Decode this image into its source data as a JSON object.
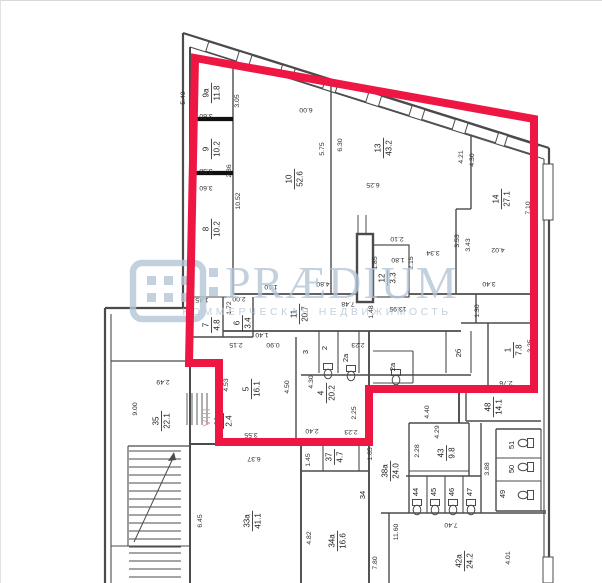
{
  "watermark": {
    "brand": "PRÆDIUM",
    "subtitle": "КОММЕРЧЕСКАЯ НЕДВИЖИМОСТЬ",
    "color": "#b5c5d7"
  },
  "highlight": {
    "label": "VIII",
    "color": "#ee1744",
    "label_color": "#e294a2",
    "points": "194,57 533,118 533,388 368,388 368,441 218,441 218,362 188,362"
  },
  "plan": {
    "line_color": "#4b4b4b",
    "thick_color": "#101010",
    "text_color": "#1c1c1c",
    "rooms": [
      {
        "num": "9а",
        "area": "11.8",
        "x": 210,
        "y": 92
      },
      {
        "num": "9",
        "area": "10.2",
        "x": 210,
        "y": 148
      },
      {
        "num": "8",
        "area": "10.2",
        "x": 210,
        "y": 228
      },
      {
        "num": "10",
        "area": "52.6",
        "x": 293,
        "y": 178
      },
      {
        "num": "13",
        "area": "43.2",
        "x": 382,
        "y": 147
      },
      {
        "num": "14",
        "area": "27.1",
        "x": 500,
        "y": 198
      },
      {
        "num": "12",
        "area": "3.3",
        "x": 386,
        "y": 277
      },
      {
        "num": "11",
        "area": "20.7",
        "x": 298,
        "y": 313
      },
      {
        "num": "6",
        "area": "3.4",
        "x": 241,
        "y": 322
      },
      {
        "num": "7",
        "area": "4.8",
        "x": 210,
        "y": 324
      },
      {
        "num": "5",
        "area": "16.1",
        "x": 250,
        "y": 388
      },
      {
        "num": "4",
        "area": "20.2",
        "x": 325,
        "y": 392
      },
      {
        "num": "1",
        "area": "7.8",
        "x": 512,
        "y": 349
      },
      {
        "num": "48",
        "area": "14.1",
        "x": 492,
        "y": 406
      },
      {
        "num": "30",
        "area": "2.4",
        "x": 222,
        "y": 420
      },
      {
        "num": "35",
        "area": "22.1",
        "x": 160,
        "y": 420
      },
      {
        "num": "33а",
        "area": "41.1",
        "x": 251,
        "y": 520
      },
      {
        "num": "34а",
        "area": "16.6",
        "x": 336,
        "y": 540
      },
      {
        "num": "37",
        "area": "4.7",
        "x": 333,
        "y": 456
      },
      {
        "num": "38а",
        "area": "24.0",
        "x": 389,
        "y": 470
      },
      {
        "num": "43",
        "area": "9.8",
        "x": 445,
        "y": 452
      },
      {
        "num": "42а",
        "area": "24.2",
        "x": 463,
        "y": 560
      }
    ],
    "stalls": [
      {
        "t": "3",
        "x": 307,
        "y": 351
      },
      {
        "t": "2",
        "x": 326,
        "y": 347
      },
      {
        "t": "2а",
        "x": 347,
        "y": 357
      },
      {
        "t": "2а",
        "x": 394,
        "y": 366
      },
      {
        "t": "2б",
        "x": 460,
        "y": 352
      },
      {
        "t": "34",
        "x": 364,
        "y": 494
      },
      {
        "t": "44",
        "x": 417,
        "y": 491
      },
      {
        "t": "45",
        "x": 435,
        "y": 491
      },
      {
        "t": "46",
        "x": 453,
        "y": 491
      },
      {
        "t": "47",
        "x": 471,
        "y": 491
      },
      {
        "t": "49",
        "x": 504,
        "y": 493
      },
      {
        "t": "50",
        "x": 513,
        "y": 468
      },
      {
        "t": "51",
        "x": 513,
        "y": 444
      }
    ],
    "dims": [
      {
        "t": "5.49",
        "x": 184,
        "y": 97,
        "rot": -90
      },
      {
        "t": "3.05",
        "x": 238,
        "y": 100,
        "rot": -90
      },
      {
        "t": "3.60",
        "x": 205,
        "y": 113,
        "rot": 180
      },
      {
        "t": "3.58",
        "x": 205,
        "y": 168,
        "rot": 180
      },
      {
        "t": "3.60",
        "x": 205,
        "y": 185,
        "rot": 180
      },
      {
        "t": "2.86",
        "x": 230,
        "y": 170,
        "rot": -90
      },
      {
        "t": "10.52",
        "x": 239,
        "y": 200,
        "rot": -90
      },
      {
        "t": "2.82",
        "x": 192,
        "y": 248,
        "rot": -90
      },
      {
        "t": "6.00",
        "x": 305,
        "y": 107,
        "rot": 180
      },
      {
        "t": "5.75",
        "x": 323,
        "y": 148,
        "rot": -90
      },
      {
        "t": "6.30",
        "x": 341,
        "y": 144,
        "rot": -90
      },
      {
        "t": "6.25",
        "x": 372,
        "y": 182,
        "rot": 180
      },
      {
        "t": "4.21",
        "x": 462,
        "y": 156,
        "rot": -90
      },
      {
        "t": "4.30",
        "x": 473,
        "y": 159,
        "rot": -90
      },
      {
        "t": "7.10",
        "x": 529,
        "y": 207,
        "rot": -90
      },
      {
        "t": "4.02",
        "x": 497,
        "y": 247,
        "rot": 180
      },
      {
        "t": "3.40",
        "x": 488,
        "y": 281,
        "rot": 180
      },
      {
        "t": "3.53",
        "x": 458,
        "y": 240,
        "rot": -90
      },
      {
        "t": "3.43",
        "x": 469,
        "y": 244,
        "rot": -90
      },
      {
        "t": "3.34",
        "x": 432,
        "y": 250,
        "rot": 180
      },
      {
        "t": "2.15",
        "x": 412,
        "y": 262,
        "rot": -90
      },
      {
        "t": "2.10",
        "x": 396,
        "y": 236,
        "rot": 180
      },
      {
        "t": "1.80",
        "x": 397,
        "y": 257,
        "rot": 180
      },
      {
        "t": "1.85",
        "x": 376,
        "y": 262,
        "rot": -90
      },
      {
        "t": "1.30",
        "x": 478,
        "y": 310,
        "rot": -90
      },
      {
        "t": "13.95",
        "x": 397,
        "y": 306,
        "rot": 180
      },
      {
        "t": "1.48",
        "x": 372,
        "y": 311,
        "rot": -90
      },
      {
        "t": "7.48",
        "x": 347,
        "y": 301,
        "rot": 180
      },
      {
        "t": "4.80",
        "x": 322,
        "y": 281,
        "rot": 180
      },
      {
        "t": "1.10",
        "x": 270,
        "y": 284,
        "rot": 180
      },
      {
        "t": "1.45",
        "x": 201,
        "y": 297,
        "rot": 180
      },
      {
        "t": "2.00",
        "x": 238,
        "y": 296,
        "rot": 180
      },
      {
        "t": "1.72",
        "x": 230,
        "y": 307,
        "rot": -90
      },
      {
        "t": "2.15",
        "x": 235,
        "y": 342,
        "rot": 180
      },
      {
        "t": "1.40",
        "x": 261,
        "y": 332,
        "rot": 180
      },
      {
        "t": "0.90",
        "x": 272,
        "y": 342,
        "rot": 180
      },
      {
        "t": "2.23",
        "x": 357,
        "y": 342,
        "rot": 180
      },
      {
        "t": "4.53",
        "x": 227,
        "y": 384,
        "rot": -90
      },
      {
        "t": "4.50",
        "x": 288,
        "y": 386,
        "rot": -90
      },
      {
        "t": "4.30",
        "x": 312,
        "y": 381,
        "rot": -90
      },
      {
        "t": "3.55",
        "x": 250,
        "y": 432,
        "rot": 180
      },
      {
        "t": "2.40",
        "x": 311,
        "y": 428,
        "rot": 180
      },
      {
        "t": "2.23",
        "x": 350,
        "y": 429,
        "rot": 180
      },
      {
        "t": "2.25",
        "x": 355,
        "y": 412,
        "rot": -90
      },
      {
        "t": "1.65",
        "x": 371,
        "y": 453,
        "rot": -90
      },
      {
        "t": "2.49",
        "x": 162,
        "y": 379,
        "rot": 180
      },
      {
        "t": "9.00",
        "x": 136,
        "y": 408,
        "rot": -90
      },
      {
        "t": "6.45",
        "x": 201,
        "y": 520,
        "rot": -90
      },
      {
        "t": "6.37",
        "x": 253,
        "y": 456,
        "rot": 180
      },
      {
        "t": "1.45",
        "x": 309,
        "y": 459,
        "rot": -90
      },
      {
        "t": "4.82",
        "x": 310,
        "y": 537,
        "rot": -90
      },
      {
        "t": "7.80",
        "x": 376,
        "y": 562,
        "rot": -90
      },
      {
        "t": "11.60",
        "x": 397,
        "y": 531,
        "rot": -90
      },
      {
        "t": "7.40",
        "x": 450,
        "y": 522,
        "rot": 180
      },
      {
        "t": "2.28",
        "x": 418,
        "y": 450,
        "rot": -90
      },
      {
        "t": "4.29",
        "x": 438,
        "y": 431,
        "rot": -90
      },
      {
        "t": "4.40",
        "x": 428,
        "y": 411,
        "rot": -90
      },
      {
        "t": "3.88",
        "x": 488,
        "y": 468,
        "rot": -90
      },
      {
        "t": "3.25",
        "x": 531,
        "y": 345,
        "rot": -90
      },
      {
        "t": "2.76",
        "x": 505,
        "y": 380,
        "rot": 180
      },
      {
        "t": "4.01",
        "x": 509,
        "y": 557,
        "rot": -90
      }
    ]
  },
  "geometry": {
    "walls": [
      [
        182,
        32,
        548,
        147,
        2.2
      ],
      [
        189,
        46,
        543,
        158,
        1.1
      ],
      [
        182,
        32,
        182,
        307,
        2.2
      ],
      [
        548,
        147,
        548,
        583,
        2.2
      ],
      [
        543,
        158,
        543,
        583,
        1.1
      ],
      [
        104,
        307,
        189,
        307,
        2.2
      ],
      [
        104,
        307,
        104,
        583,
        2.2
      ],
      [
        110,
        313,
        110,
        583,
        1.1
      ],
      [
        189,
        46,
        189,
        583,
        2.0
      ],
      [
        110,
        360,
        189,
        360,
        1.3
      ],
      [
        127,
        445,
        189,
        445,
        1.3
      ],
      [
        127,
        445,
        127,
        545,
        1.1
      ],
      [
        110,
        545,
        189,
        545,
        1.1
      ],
      [
        232,
        48,
        232,
        293,
        1.4
      ],
      [
        189,
        118,
        232,
        118,
        4.2
      ],
      [
        189,
        172,
        232,
        172,
        4.2
      ],
      [
        330,
        79,
        330,
        293,
        1.4
      ],
      [
        470,
        122,
        470,
        208,
        1.4
      ],
      [
        455,
        208,
        470,
        208,
        1.4
      ],
      [
        455,
        208,
        455,
        293,
        1.4
      ],
      [
        232,
        293,
        535,
        293,
        1.8
      ],
      [
        189,
        296,
        232,
        296,
        1.1
      ],
      [
        222,
        296,
        222,
        336,
        1.4
      ],
      [
        252,
        296,
        252,
        336,
        1.4
      ],
      [
        189,
        336,
        252,
        336,
        1.4
      ],
      [
        222,
        330,
        460,
        330,
        1.8
      ],
      [
        475,
        293,
        475,
        322,
        1.4
      ],
      [
        460,
        322,
        535,
        322,
        1.4
      ],
      [
        487,
        322,
        487,
        390,
        1.4
      ],
      [
        295,
        336,
        295,
        443,
        1.4
      ],
      [
        368,
        330,
        368,
        583,
        1.9
      ],
      [
        189,
        443,
        368,
        443,
        1.9
      ],
      [
        300,
        443,
        300,
        583,
        1.9
      ],
      [
        318,
        330,
        318,
        372,
        1.1
      ],
      [
        337,
        330,
        337,
        372,
        1.1
      ],
      [
        358,
        330,
        358,
        372,
        1.1
      ],
      [
        445,
        330,
        445,
        372,
        1.1
      ],
      [
        470,
        330,
        470,
        372,
        1.1
      ],
      [
        300,
        374,
        470,
        374,
        1.4
      ],
      [
        372,
        350,
        412,
        350,
        1.1
      ],
      [
        412,
        350,
        412,
        382,
        1.1
      ],
      [
        372,
        382,
        412,
        382,
        1.1
      ],
      [
        357,
        214,
        357,
        233,
        1.0
      ],
      [
        365,
        214,
        365,
        233,
        1.0
      ],
      [
        458,
        390,
        458,
        422,
        1.9
      ],
      [
        408,
        422,
        468,
        422,
        1.4
      ],
      [
        408,
        422,
        408,
        512,
        1.4
      ],
      [
        468,
        422,
        468,
        475,
        1.4
      ],
      [
        405,
        475,
        480,
        475,
        1.4
      ],
      [
        426,
        475,
        426,
        512,
        1.1
      ],
      [
        444,
        475,
        444,
        512,
        1.1
      ],
      [
        462,
        475,
        462,
        512,
        1.1
      ],
      [
        480,
        422,
        480,
        512,
        1.4
      ],
      [
        408,
        470,
        468,
        470,
        1.1
      ],
      [
        465,
        420,
        540,
        420,
        1.4
      ],
      [
        465,
        390,
        465,
        420,
        1.4
      ],
      [
        495,
        428,
        495,
        510,
        1.4
      ],
      [
        495,
        428,
        540,
        428,
        1.4
      ],
      [
        495,
        457,
        540,
        457,
        1.1
      ],
      [
        495,
        480,
        540,
        480,
        1.1
      ],
      [
        495,
        510,
        545,
        510,
        1.4
      ],
      [
        540,
        428,
        540,
        510,
        1.1
      ],
      [
        380,
        512,
        545,
        512,
        1.4
      ],
      [
        388,
        512,
        388,
        583,
        1.4
      ],
      [
        300,
        470,
        368,
        470,
        1.4
      ],
      [
        322,
        443,
        322,
        470,
        1.1
      ],
      [
        358,
        443,
        358,
        470,
        1.1
      ]
    ],
    "boxes": [
      [
        372,
        244,
        36,
        52,
        1.2
      ],
      [
        356,
        233,
        16,
        68,
        2.4
      ]
    ],
    "windows": [
      [
        205.5,
        45.4,
        32,
        10,
        17.5
      ],
      [
        248.7,
        59.0,
        32,
        10,
        17.5
      ],
      [
        291.9,
        72.6,
        32,
        10,
        17.5
      ],
      [
        335.1,
        86.2,
        32,
        10,
        17.5
      ],
      [
        378.3,
        99.8,
        32,
        10,
        17.5
      ],
      [
        421.5,
        113.4,
        32,
        10,
        17.5
      ],
      [
        464.7,
        127.0,
        32,
        10,
        17.5
      ],
      [
        504.3,
        139.6,
        32,
        10,
        17.5
      ],
      [
        542,
        163,
        10,
        56,
        0
      ],
      [
        542,
        556,
        10,
        26,
        0
      ]
    ],
    "stairs": [
      {
        "x1": 128,
        "x2": 180,
        "y0": 450,
        "step": 8,
        "n": 12
      },
      {
        "x1": 128,
        "x2": 180,
        "y0": 552,
        "step": 8,
        "n": 4
      }
    ],
    "small_stair": {
      "y1": 392,
      "y2": 424,
      "x0": 186,
      "step": 5,
      "n": 5
    },
    "stair_arrow": {
      "x1": 133,
      "y1": 541,
      "x2": 173,
      "y2": 455
    },
    "wc": [
      [
        416,
        502,
        0
      ],
      [
        434,
        502,
        0
      ],
      [
        452,
        502,
        0
      ],
      [
        470,
        502,
        0
      ],
      [
        529,
        442,
        90
      ],
      [
        529,
        466,
        90
      ],
      [
        529,
        494,
        90
      ],
      [
        327,
        366,
        0
      ],
      [
        350,
        368,
        0
      ],
      [
        395,
        372,
        0
      ]
    ]
  }
}
